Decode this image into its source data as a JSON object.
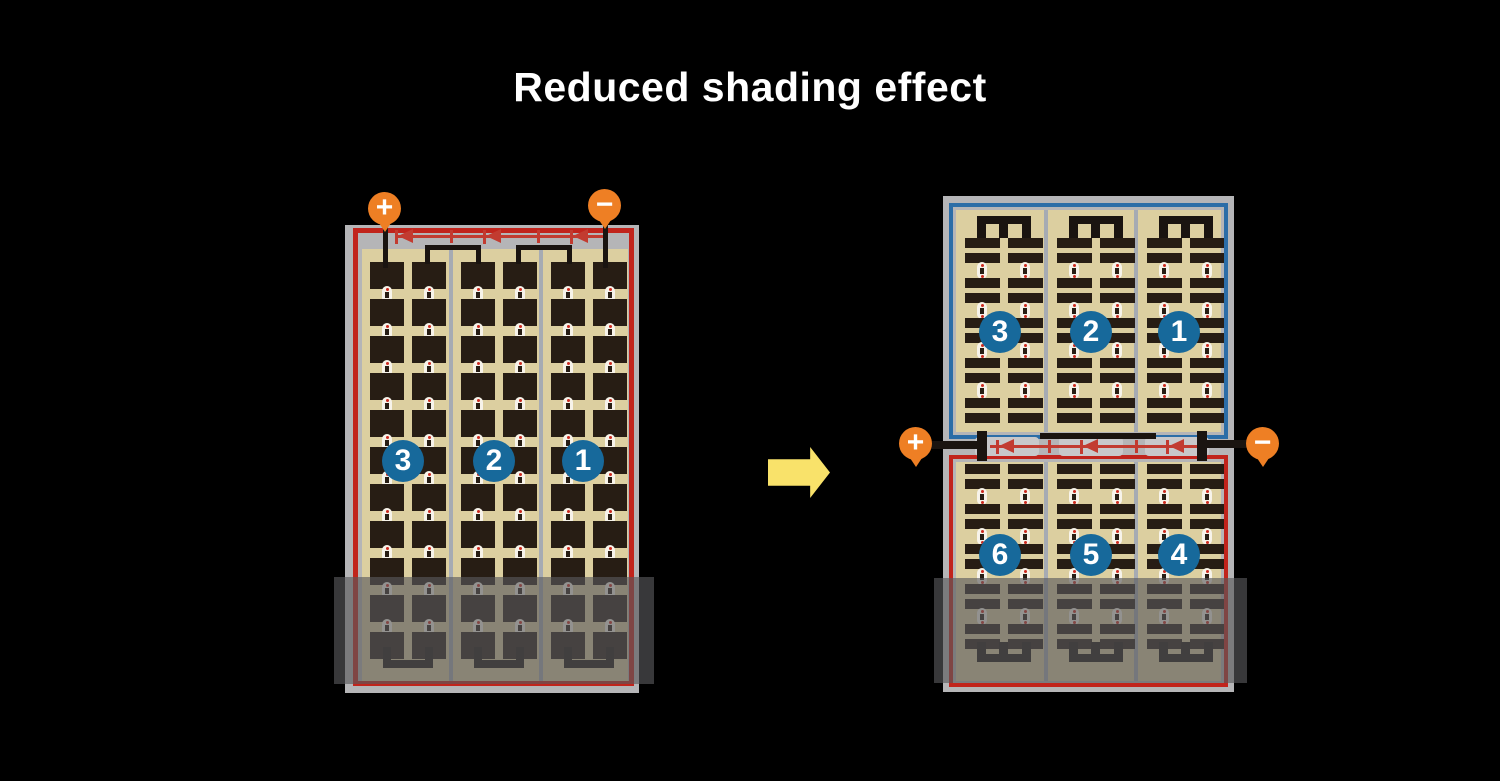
{
  "title": "Reduced shading effect",
  "left_module": {
    "terminals": {
      "positive": "+",
      "negative": "−"
    },
    "strings": [
      "3",
      "2",
      "1"
    ]
  },
  "right_module": {
    "terminals": {
      "positive": "+",
      "negative": "−"
    },
    "top_strings": [
      "3",
      "2",
      "1"
    ],
    "bottom_strings": [
      "6",
      "5",
      "4"
    ]
  },
  "icons": {
    "positive_terminal": "plus-terminal-icon",
    "negative_terminal": "minus-terminal-icon",
    "transform_arrow": "right-arrow-icon",
    "bypass_diode": "bypass-diode-icon",
    "cell_connector": "cell-connector-icon"
  },
  "colors": {
    "background": "#000000",
    "frame_gray": "#b5b5b7",
    "cell_area_tan": "#dccfa0",
    "cell_dark": "#271d14",
    "divider_gray": "#a6abb3",
    "border_red": "#c1241c",
    "border_blue": "#2b6da7",
    "diode_red": "#c23b30",
    "badge_blue": "#17699b",
    "terminal_orange": "#ee7f24",
    "arrow_yellow": "#f9e26a",
    "wire_black": "#1a1410",
    "connector_white": "#f7f3ea",
    "connector_red": "#cc2a1f",
    "diode_package_gray": "#c8c8ca",
    "shade_overlay": "rgba(88,88,92,0.63)"
  }
}
